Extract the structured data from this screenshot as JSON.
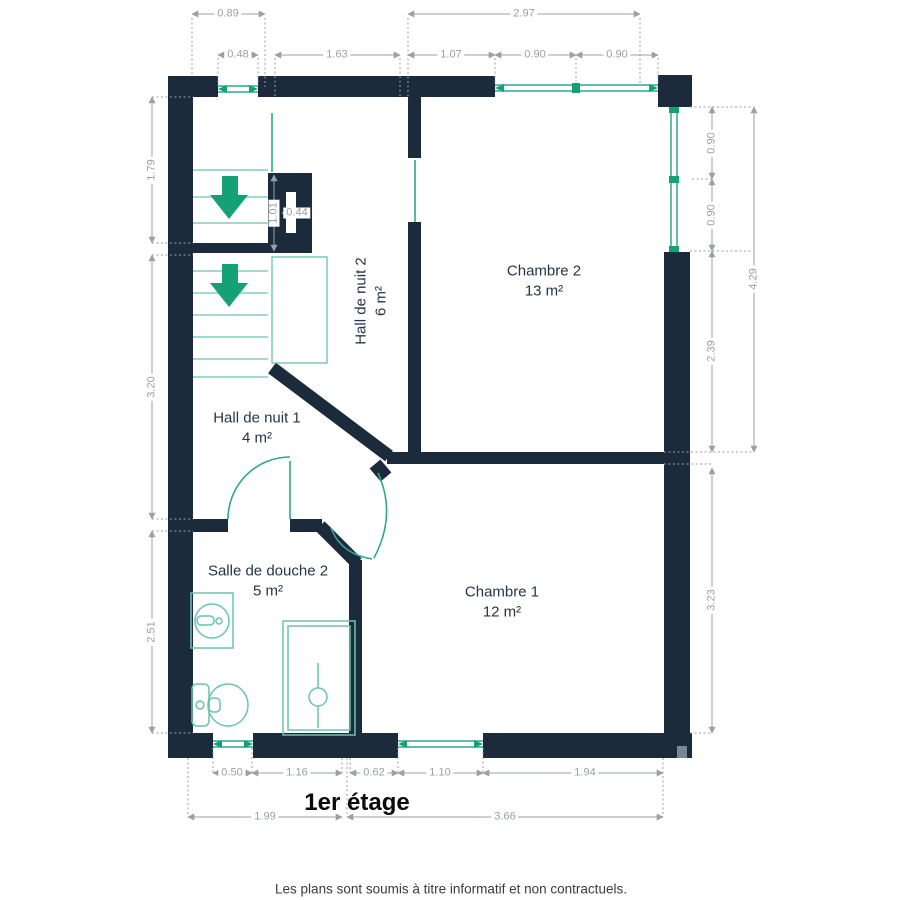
{
  "title": "1er étage",
  "disclaimer": "Les plans sont soumis à titre informatif et non contractuels.",
  "rooms": [
    {
      "name": "Chambre 2",
      "area": "13 m²"
    },
    {
      "name": "Chambre 1",
      "area": "12 m²"
    },
    {
      "name": "Hall de nuit 2",
      "area": "6 m²"
    },
    {
      "name": "Hall de nuit 1",
      "area": "4 m²"
    },
    {
      "name": "Salle de douche 2",
      "area": "5 m²"
    }
  ],
  "dimensions": {
    "top": [
      "0.89",
      "2.97",
      "0.48",
      "1.63",
      "1.07",
      "0.90",
      "0.90"
    ],
    "left": [
      "1.79",
      "3.20",
      "2.51"
    ],
    "right": [
      "0.90",
      "0.90",
      "2.39",
      "4.29",
      "3.23"
    ],
    "bottom": [
      "0.50",
      "1.16",
      "0.62",
      "1.10",
      "1.94",
      "1.99",
      "3.66"
    ],
    "duct": [
      "1.01",
      "0.44"
    ]
  },
  "icons": {
    "stair_arrow": "arrow-down",
    "sink": "washbasin",
    "toilet": "wc",
    "shower": "shower-tray"
  },
  "colors": {
    "wall": "#1b2b3c",
    "window": "#2fa78d",
    "fixture": "#6ac4b1",
    "arrow": "#14a173",
    "dimension": "#9aa0a6",
    "room_label": "#24364a"
  }
}
